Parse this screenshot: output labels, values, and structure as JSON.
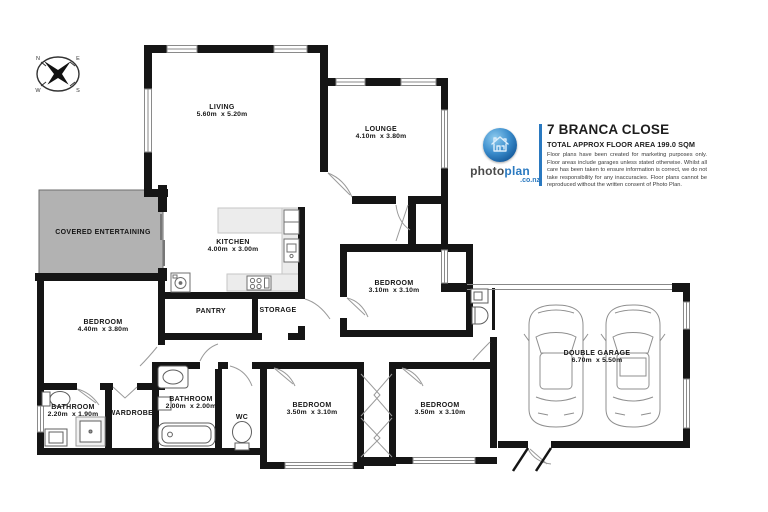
{
  "title_block": {
    "address": "7 BRANCA CLOSE",
    "area_line": "TOTAL APPROX FLOOR AREA 199.0 SQM",
    "disclaimer": "Floor plans have been created for marketing purposes only. Floor areas include garages unless stated otherwise. Whilst all care has been taken to ensure information is correct, we do not take responsibility for any inaccuracies. Floor plans cannot be reproduced without the written consent of Photo Plan."
  },
  "logo": {
    "word1": "photo",
    "word2": "plan",
    "domain": ".co.nz",
    "accent_color": "#2a79c0"
  },
  "compass": {
    "points": [
      "N",
      "E",
      "S",
      "W"
    ]
  },
  "colors": {
    "wall": "#151515",
    "covered_fill": "#b2b2b2",
    "counter_fill": "#ececec",
    "accent_blue": "#2a79c0"
  },
  "rooms": [
    {
      "name": "LIVING",
      "dims": "5.60m  x 5.20m"
    },
    {
      "name": "LOUNGE",
      "dims": "4.10m  x 3.80m"
    },
    {
      "name": "COVERED ENTERTAINING",
      "dims": ""
    },
    {
      "name": "KITCHEN",
      "dims": "4.00m  x 3.00m"
    },
    {
      "name": "BEDROOM",
      "dims": "3.10m  x 3.10m"
    },
    {
      "name": "BEDROOM",
      "dims": "4.40m  x 3.80m"
    },
    {
      "name": "PANTRY",
      "dims": ""
    },
    {
      "name": "STORAGE",
      "dims": ""
    },
    {
      "name": "BATHROOM",
      "dims": "2.20m  x 1.90m"
    },
    {
      "name": "WARDROBE",
      "dims": ""
    },
    {
      "name": "BATHROOM",
      "dims": "2.00m  x 2.00m"
    },
    {
      "name": "WC",
      "dims": ""
    },
    {
      "name": "BEDROOM",
      "dims": "3.50m  x 3.10m"
    },
    {
      "name": "BEDROOM",
      "dims": "3.50m  x 3.10m"
    },
    {
      "name": "DOUBLE GARAGE",
      "dims": "6.70m  x 5.50m"
    }
  ]
}
